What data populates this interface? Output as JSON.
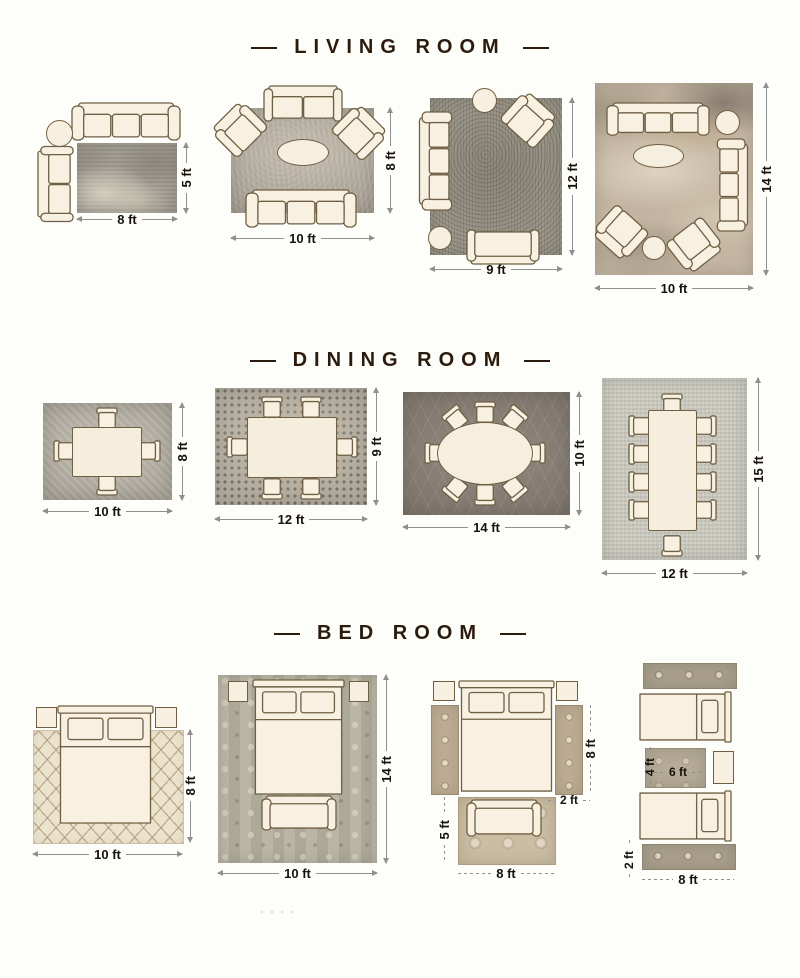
{
  "colors": {
    "background": "#fdfdfa",
    "title_text": "#2b1b0d",
    "dimension_text": "#17110b",
    "dimension_line": "#8f8f8f",
    "furniture_fill": "#f8f1e1",
    "furniture_outline": "#6f5f44"
  },
  "sections": {
    "living": {
      "title": "LIVING ROOM",
      "l1": {
        "width_label": "8 ft",
        "height_label": "5 ft"
      },
      "l2": {
        "width_label": "10 ft",
        "height_label": "8 ft"
      },
      "l3": {
        "width_label": "9 ft",
        "height_label": "12 ft"
      },
      "l4": {
        "width_label": "10 ft",
        "height_label": "14 ft"
      }
    },
    "dining": {
      "title": "DINING ROOM",
      "d1": {
        "width_label": "10 ft",
        "height_label": "8 ft"
      },
      "d2": {
        "width_label": "12 ft",
        "height_label": "9 ft"
      },
      "d3": {
        "width_label": "14 ft",
        "height_label": "10 ft"
      },
      "d4": {
        "width_label": "12 ft",
        "height_label": "15 ft"
      }
    },
    "bed": {
      "title": "BED ROOM",
      "b1": {
        "width_label": "10 ft",
        "height_label": "8 ft"
      },
      "b2": {
        "width_label": "10 ft",
        "height_label": "14 ft"
      },
      "b3": {
        "side_runner_length_label": "8 ft",
        "side_runner_width_label": "2 ft",
        "foot_rug_height_label": "5 ft",
        "foot_rug_width_label": "8 ft"
      },
      "b4": {
        "between_rug_height_label": "4 ft",
        "between_rug_width_label": "6 ft",
        "runner_width_label": "2 ft",
        "runner_length_label": "8 ft"
      }
    }
  }
}
